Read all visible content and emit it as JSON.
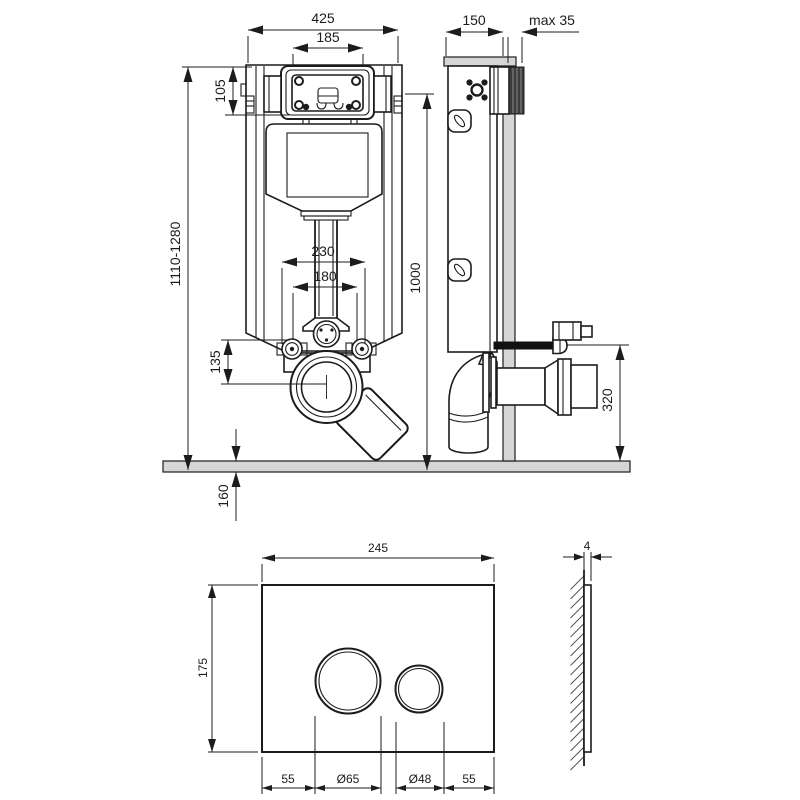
{
  "drawing": {
    "frame_front": {
      "width": "425",
      "service_opening_width": "185",
      "service_opening_height": "105",
      "install_height_range": "1110-1280",
      "fixing_height": "1000",
      "bolt_spacing_outer": "230",
      "bolt_spacing_inner": "180",
      "outlet_offset": "135",
      "floor_recess": "160"
    },
    "frame_side": {
      "depth": "150",
      "wall_finish_max": "max 35",
      "outlet_height": "320"
    },
    "plate_front": {
      "width": "245",
      "height": "175",
      "margin_left": "55",
      "big_button_diameter": "Ø65",
      "small_button_diameter": "Ø48",
      "margin_right": "55"
    },
    "plate_side": {
      "thickness": "4"
    }
  }
}
